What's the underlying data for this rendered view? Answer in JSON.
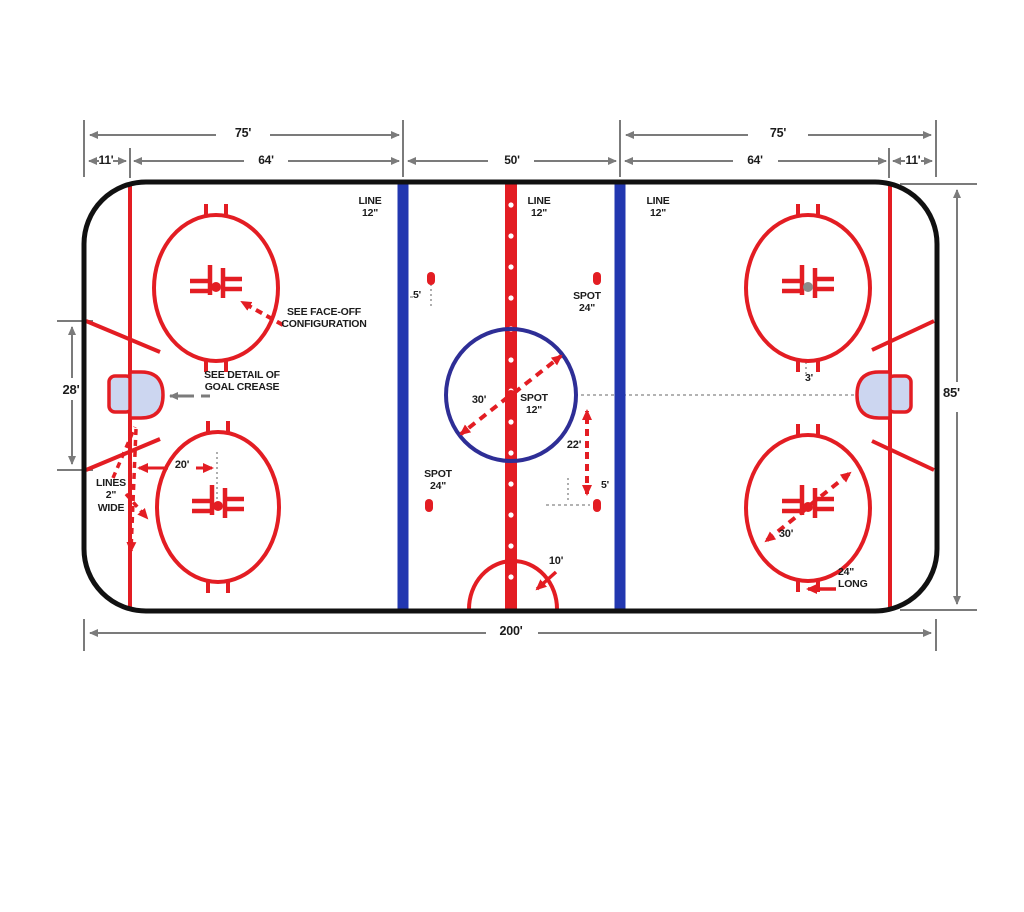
{
  "diagram": {
    "subject": "ice-hockey-rink-dimensions",
    "colors": {
      "marking_red": "#e31d23",
      "blue_line": "#2237b0",
      "center_circle_navy": "#2e2e96",
      "crease_fill": "#ccd6f0",
      "boards_black": "#111111",
      "dimension_gray": "#7b7b7b",
      "dashed_gray": "#9a9a9a",
      "faceoff_dot_gray": "#8a8a8a",
      "text_black": "#1c1c1c"
    }
  },
  "labels": [
    {
      "name": "dim-75-left",
      "text": "75'",
      "x": 213,
      "y": 126,
      "w": 60,
      "align": "center",
      "size": 12.5
    },
    {
      "name": "dim-11-left",
      "text": "11'",
      "x": 90,
      "y": 153,
      "w": 32,
      "align": "center",
      "size": 12
    },
    {
      "name": "dim-64-left",
      "text": "64'",
      "x": 236,
      "y": 153,
      "w": 60,
      "align": "center",
      "size": 12
    },
    {
      "name": "dim-50-center",
      "text": "50'",
      "x": 482,
      "y": 153,
      "w": 60,
      "align": "center",
      "size": 12
    },
    {
      "name": "dim-75-right",
      "text": "75'",
      "x": 748,
      "y": 126,
      "w": 60,
      "align": "center",
      "size": 12.5
    },
    {
      "name": "dim-64-right",
      "text": "64'",
      "x": 725,
      "y": 153,
      "w": 60,
      "align": "center",
      "size": 12
    },
    {
      "name": "dim-11-right",
      "text": "11'",
      "x": 897,
      "y": 153,
      "w": 32,
      "align": "center",
      "size": 12
    },
    {
      "name": "dim-200-bottom",
      "text": "200'",
      "x": 481,
      "y": 624,
      "w": 60,
      "align": "center",
      "size": 12.5
    },
    {
      "name": "dim-85-right",
      "text": "85'",
      "x": 943,
      "y": 385,
      "w": 34,
      "align": "left",
      "size": 13
    },
    {
      "name": "dim-28-left",
      "text": "28'",
      "x": 54,
      "y": 382,
      "w": 34,
      "align": "center",
      "size": 13
    },
    {
      "name": "line-12-left",
      "text": "LINE\n12\"",
      "x": 352,
      "y": 195,
      "w": 36,
      "align": "center",
      "size": 10.5
    },
    {
      "name": "line-12-center",
      "text": "LINE\n12\"",
      "x": 521,
      "y": 195,
      "w": 36,
      "align": "center",
      "size": 10.5
    },
    {
      "name": "line-12-right",
      "text": "LINE\n12\"",
      "x": 640,
      "y": 195,
      "w": 36,
      "align": "center",
      "size": 10.5
    },
    {
      "name": "see-faceoff-note",
      "text": "SEE FACE-OFF\nCONFIGURATION",
      "x": 277,
      "y": 306,
      "w": 94,
      "align": "center",
      "size": 10.5
    },
    {
      "name": "see-crease-note",
      "text": "SEE DETAIL OF\nGOAL CREASE",
      "x": 200,
      "y": 369,
      "w": 84,
      "align": "center",
      "size": 10.5
    },
    {
      "name": "lines-2-wide-note",
      "text": "LINES\n2\"\nWIDE",
      "x": 90,
      "y": 477,
      "w": 42,
      "align": "center",
      "size": 10.5
    },
    {
      "name": "dim-20-faceoff",
      "text": "20'",
      "x": 168,
      "y": 459,
      "w": 28,
      "align": "center",
      "size": 11
    },
    {
      "name": "dim-5-top-spot",
      "text": "5'",
      "x": 413,
      "y": 289,
      "w": 18,
      "align": "left",
      "size": 10.5
    },
    {
      "name": "spot-24-top",
      "text": "SPOT\n24\"",
      "x": 566,
      "y": 290,
      "w": 42,
      "align": "center",
      "size": 10.5
    },
    {
      "name": "dim-30-center",
      "text": "30'",
      "x": 464,
      "y": 394,
      "w": 30,
      "align": "center",
      "size": 11
    },
    {
      "name": "spot-12-center",
      "text": "SPOT\n12\"",
      "x": 514,
      "y": 392,
      "w": 40,
      "align": "center",
      "size": 10.5
    },
    {
      "name": "dim-22-neutral",
      "text": "22'",
      "x": 560,
      "y": 439,
      "w": 28,
      "align": "center",
      "size": 11
    },
    {
      "name": "dim-5-bottom-spot",
      "text": "5'",
      "x": 601,
      "y": 479,
      "w": 18,
      "align": "left",
      "size": 10.5
    },
    {
      "name": "spot-24-bottom",
      "text": "SPOT\n24\"",
      "x": 417,
      "y": 468,
      "w": 42,
      "align": "center",
      "size": 10.5
    },
    {
      "name": "dim-10-referee",
      "text": "10'",
      "x": 541,
      "y": 555,
      "w": 30,
      "align": "center",
      "size": 11
    },
    {
      "name": "dim-3-hash",
      "text": "3'",
      "x": 799,
      "y": 372,
      "w": 20,
      "align": "center",
      "size": 10.5
    },
    {
      "name": "dim-30-bottom-right",
      "text": "30'",
      "x": 771,
      "y": 528,
      "w": 30,
      "align": "center",
      "size": 11
    },
    {
      "name": "dim-24-long",
      "text": "24\"\nLONG",
      "x": 838,
      "y": 566,
      "w": 48,
      "align": "left",
      "size": 10.5
    }
  ]
}
